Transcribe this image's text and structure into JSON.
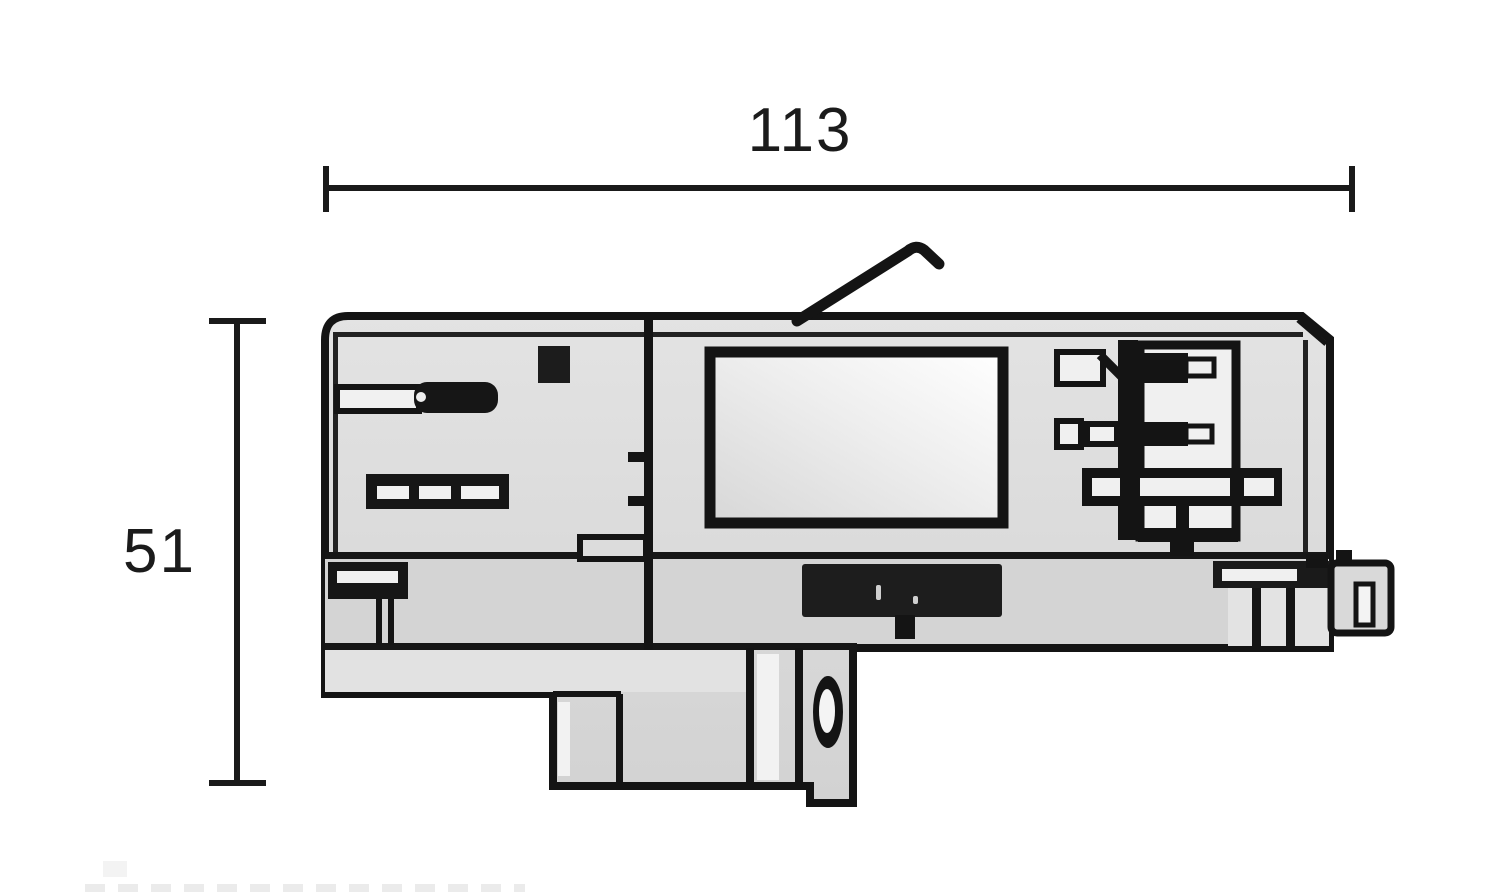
{
  "drawing": {
    "kind": "technical dimension drawing, side elevation of a track-lighting adapter",
    "width_dimension": {
      "label": "113",
      "orientation": "horizontal",
      "position": "top"
    },
    "height_dimension": {
      "label": "51",
      "orientation": "vertical",
      "position": "left"
    },
    "colors": {
      "line": "#141414",
      "body_fill": "#d9d9d9",
      "band_fill": "#d4d4d4",
      "slot_fill": "#f0f0f0",
      "background": "#ffffff"
    }
  }
}
